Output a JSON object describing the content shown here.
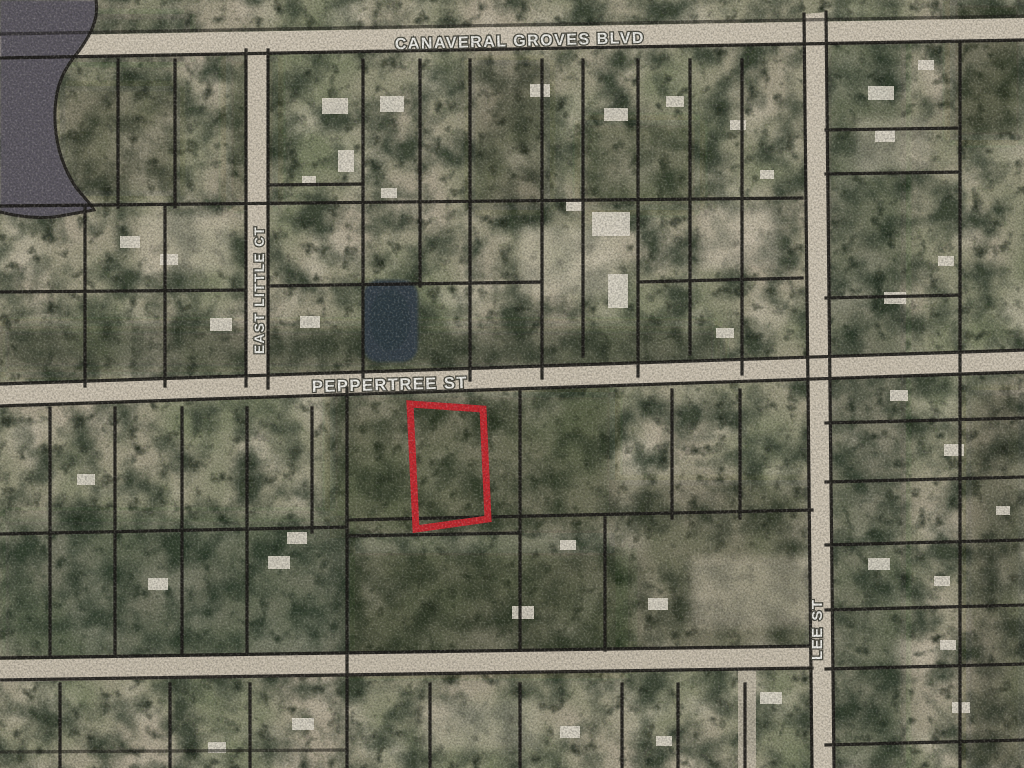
{
  "map": {
    "kind": "aerial-parcel-map",
    "street_labels": {
      "canaveral_groves_blvd": "CANAVERAL GROVES BLVD",
      "peppertree_st": "PEPPERTREE ST",
      "east_little_ct": "EAST LITTLE CT",
      "lee_st": "LEE ST"
    },
    "highlight": {
      "name": "subject parcel outline",
      "color": "#d2232a"
    },
    "colors": {
      "terrain_base": "#a89e8b",
      "road_surface": "#d2c7b3",
      "parcel_line": "#171513",
      "lake_water": "#5a5660",
      "pond_water": "#333e46",
      "label_text": "#f4f3ec"
    }
  }
}
